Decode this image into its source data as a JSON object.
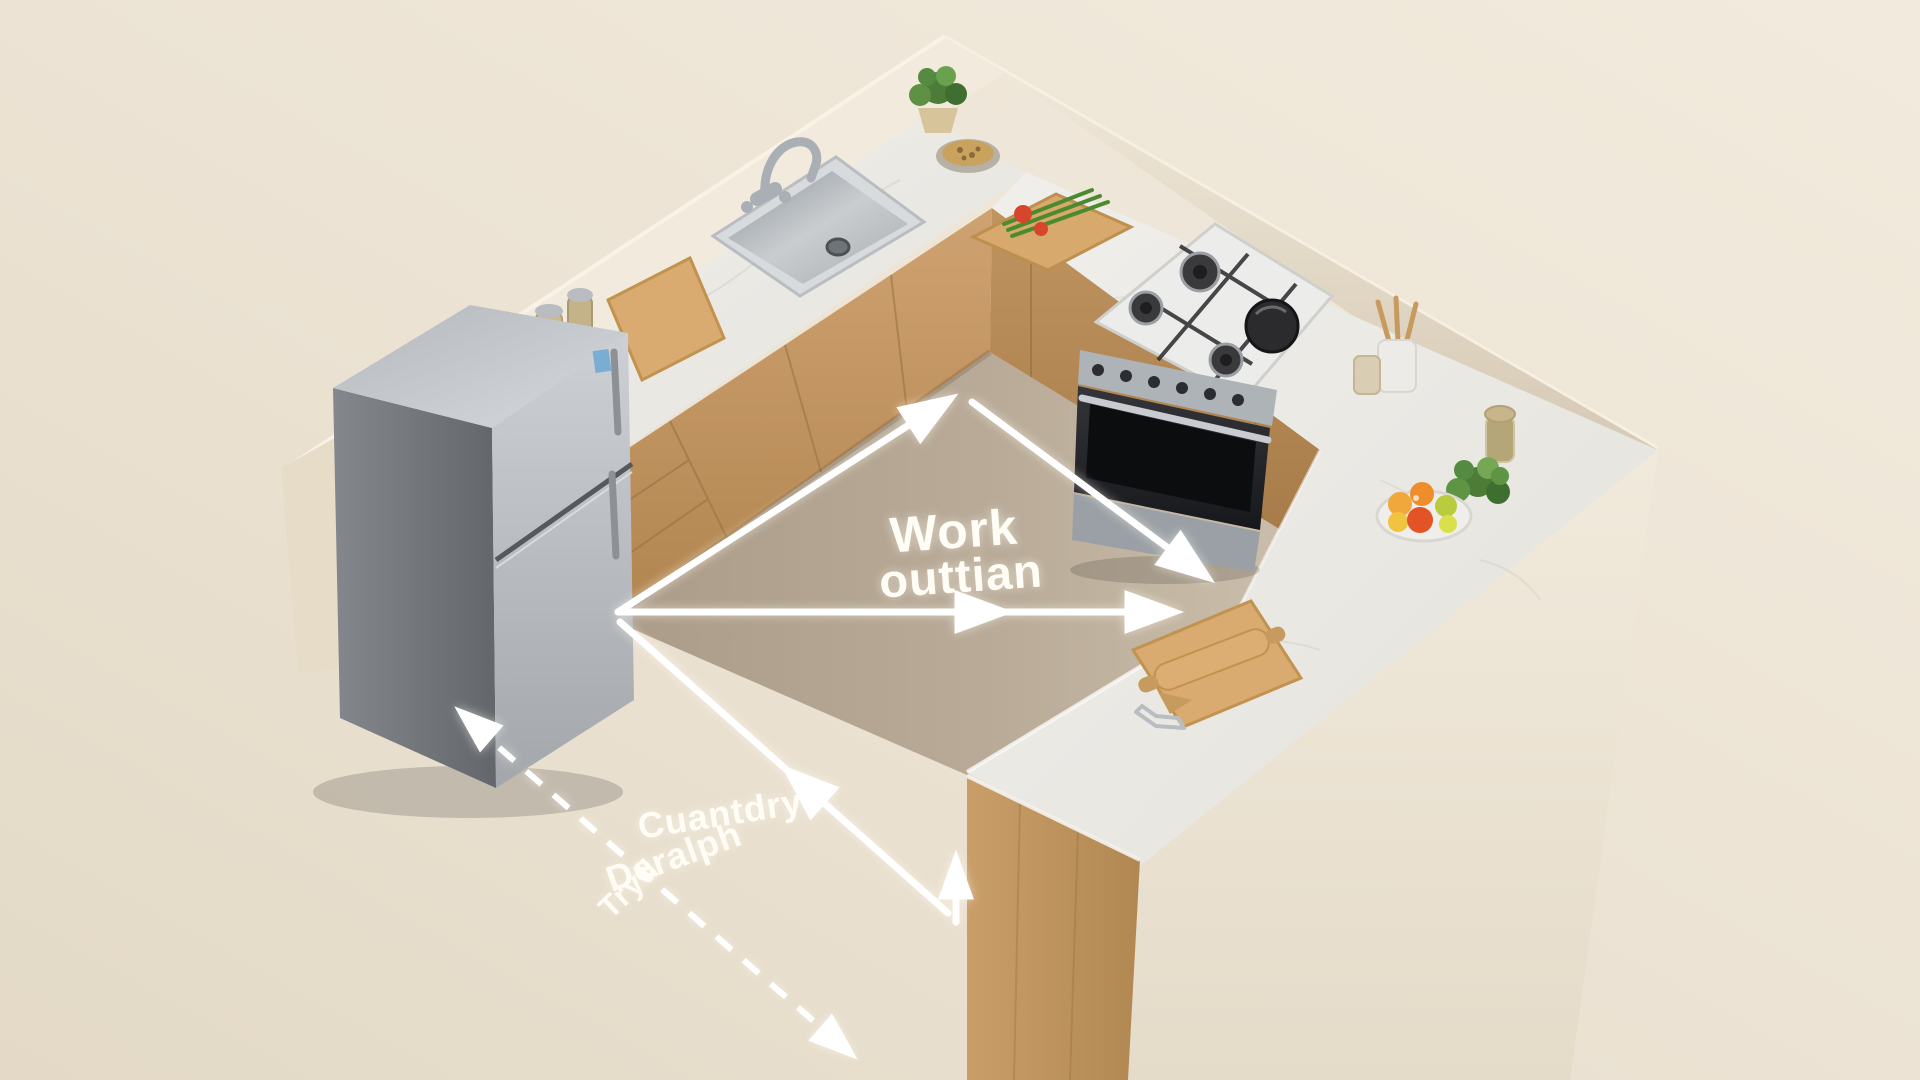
{
  "scene": {
    "description": "Isometric 3D illustration of a kitchen work triangle",
    "background_color": "#ebe2d2",
    "floor_color": "#b2a390",
    "wall_color": "#f1e9da",
    "cabinet_wood_color": "#c59c6a",
    "countertop_color": "#edece8",
    "stainless_color": "#b9bdc1",
    "arrow_color": "#ffffff"
  },
  "labels": {
    "work_triangle": {
      "line1": "Work",
      "line2": "outtian"
    },
    "distance": {
      "line1": "Cuantdry",
      "line2": "Deralph",
      "line3": "Tryd"
    }
  },
  "objects": [
    "refrigerator",
    "kitchen sink",
    "gooseneck faucet",
    "gas cooktop with pan",
    "oven",
    "cutting board with jars",
    "potted herb",
    "snack bowl",
    "vegetable cutting board",
    "utensil crock",
    "spice jar",
    "herb bunch",
    "fruit bowl",
    "rolling pin on island board"
  ]
}
